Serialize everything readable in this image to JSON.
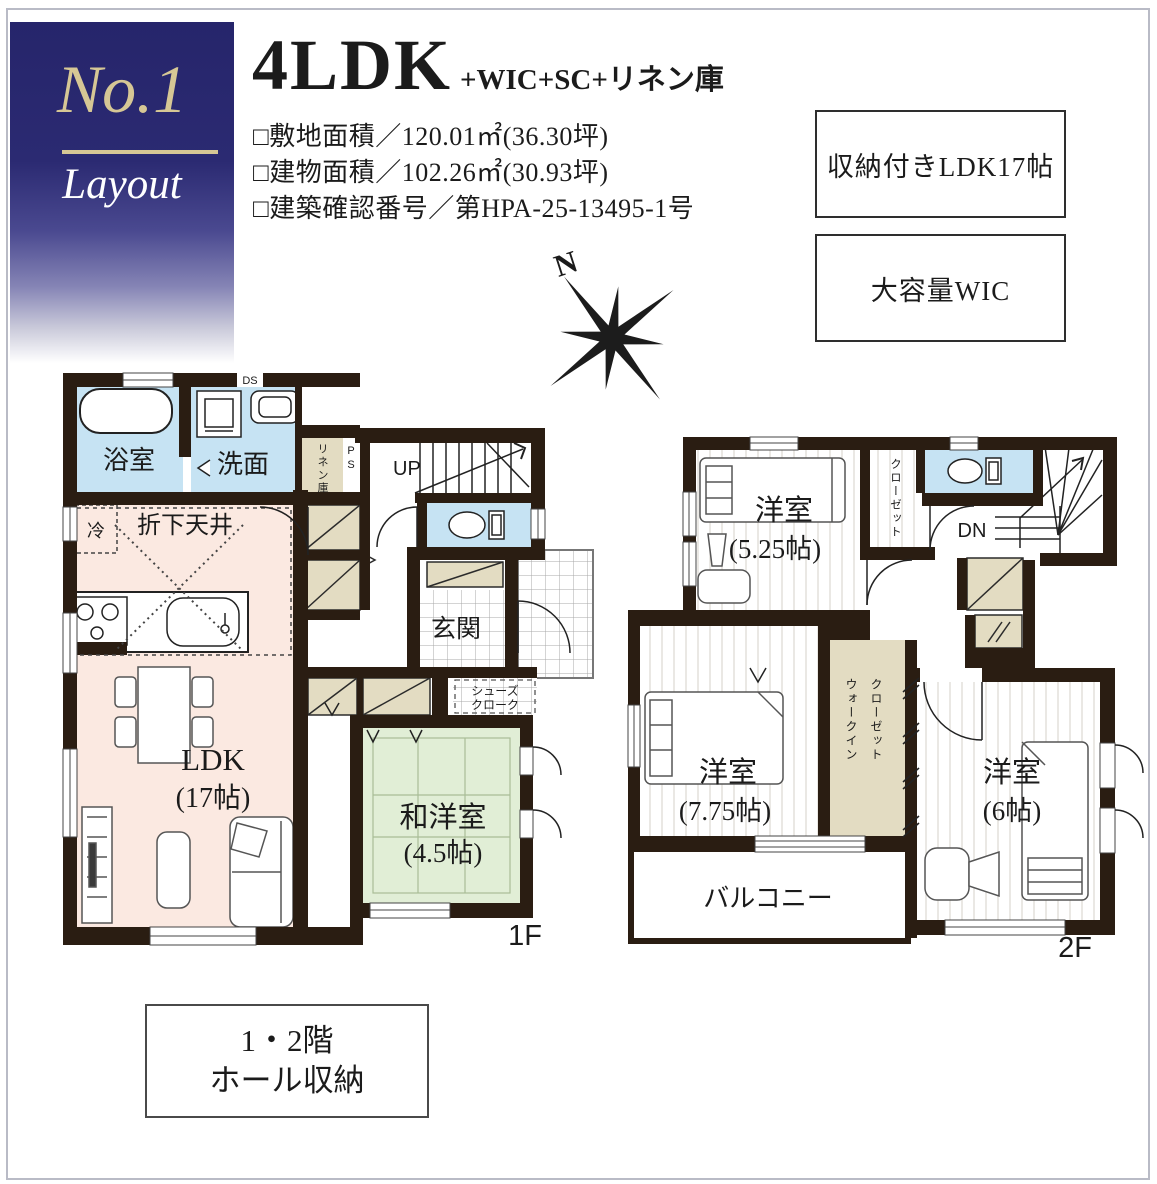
{
  "badge": {
    "number": "No.1",
    "label": "Layout"
  },
  "header": {
    "title": "4LDK",
    "title_suffix": "+WIC+SC+リネン庫",
    "specs": [
      "□敷地面積／120.01㎡(36.30坪)",
      "□建物面積／102.26㎡(30.93坪)",
      "□建築確認番号／第HPA-25-13495-1号"
    ],
    "features": [
      "収納付きLDK17帖",
      "大容量WIC"
    ],
    "compass_n": "N"
  },
  "floor1": {
    "label": "1F",
    "rooms": {
      "bath": "浴室",
      "wash": "洗面",
      "ds": "DS",
      "linen": "リネン庫",
      "ps": "PS",
      "up": "UP",
      "ceiling": "折下天井",
      "fridge": "冷",
      "genkan": "玄関",
      "sc1": "シューズ",
      "sc2": "クローク",
      "ldk": "LDK",
      "ldk_size": "(17帖)",
      "waroom": "和洋室",
      "waroom_size": "(4.5帖)"
    }
  },
  "floor2": {
    "label": "2F",
    "rooms": {
      "room1": "洋室",
      "room1_size": "(5.25帖)",
      "closet": "クローゼット",
      "dn": "DN",
      "room2": "洋室",
      "room2_size": "(7.75帖)",
      "wic1": "ウォークイン",
      "wic2": "クローゼット",
      "room3": "洋室",
      "room3_size": "(6帖)",
      "balcony": "バルコニー"
    }
  },
  "note": {
    "line1": "1・2階",
    "line2": "ホール収納"
  },
  "colors": {
    "accent_navy": "#26256b",
    "badge_cream": "#d6c795",
    "wall": "#2a1d12",
    "bath_blue": "#c6e3f3",
    "ldk_pink": "#fbe9e1",
    "tatami_green": "#e1eed6",
    "closet_beige": "#e3dcc2",
    "frame_gray": "#b9bbc6"
  }
}
